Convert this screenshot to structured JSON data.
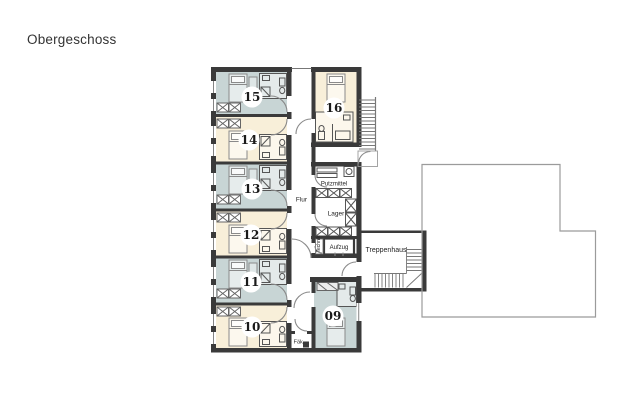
{
  "title": "Obergeschoss",
  "rooms": [
    {
      "number": "15",
      "type": "blue"
    },
    {
      "number": "14",
      "type": "cream"
    },
    {
      "number": "13",
      "type": "blue"
    },
    {
      "number": "12",
      "type": "cream"
    },
    {
      "number": "11",
      "type": "blue"
    },
    {
      "number": "10",
      "type": "cream"
    },
    {
      "number": "16",
      "type": "cream"
    },
    {
      "number": "09",
      "type": "blue"
    }
  ],
  "areas": {
    "corridor": "Flur",
    "cleaning": "Putzmittel",
    "storage": "Lager",
    "elevator": "Aufzug",
    "stairwell": "Treppenhaus",
    "shaft": "Technik",
    "fecal": "Fäk."
  },
  "colors": {
    "room_blue": "#c8d5d5",
    "room_cream": "#f8efd9",
    "wall": "#3a3a3a",
    "thin_wall": "#555555",
    "door": "#8a8a8a",
    "furniture": "#8a8a8a",
    "stair": "#777777",
    "outline": "#9b9b9b",
    "text": "#222222"
  }
}
